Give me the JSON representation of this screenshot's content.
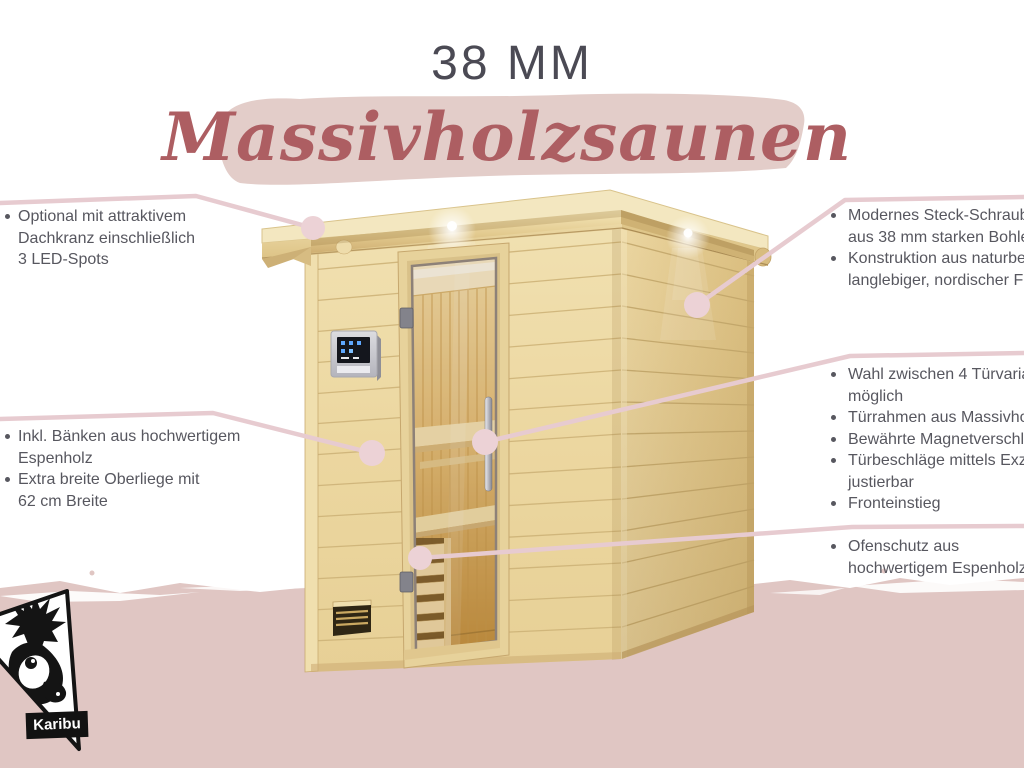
{
  "header": {
    "size_label": "38 MM",
    "product_line": "Massivholzsaunen"
  },
  "brand": {
    "name": "Karibu"
  },
  "bullets": {
    "left_top": [
      {
        "lines": [
          "Optional mit attraktivem",
          "Dachkranz einschließlich",
          "3 LED-Spots"
        ]
      }
    ],
    "left_mid": [
      {
        "lines": [
          "Inkl. Bänken aus hochwertigem",
          "Espenholz"
        ]
      },
      {
        "lines": [
          "Extra breite Oberliege mit",
          "62 cm Breite"
        ]
      }
    ],
    "right_top": [
      {
        "lines": [
          "Modernes Steck-Schraubsystem",
          "aus 38 mm starken Bohlen"
        ]
      },
      {
        "lines": [
          "Konstruktion aus naturbelassener,",
          "langlebiger, nordischer Fichte"
        ]
      }
    ],
    "right_mid": [
      {
        "lines": [
          "Wahl zwischen 4 Türvarianten",
          "möglich"
        ]
      },
      {
        "lines": [
          "Türrahmen aus Massivholz"
        ]
      },
      {
        "lines": [
          "Bewährte Magnetverschlusstechnik"
        ]
      },
      {
        "lines": [
          "Türbeschläge mittels Exzenter",
          "justierbar"
        ]
      },
      {
        "lines": [
          "Fronteinstieg"
        ]
      }
    ],
    "right_bottom": [
      {
        "lines": [
          "Ofenschutz aus",
          "hochwertigem Espenholz"
        ]
      }
    ]
  },
  "icons": {
    "brand_logo": "deer-triangle-logo",
    "callout_marker": "pink-dot-marker"
  },
  "colors": {
    "title_gray": "#4b4a54",
    "script_red": "#ad5e62",
    "brush_pink": "#e3cdc9",
    "footer_pink": "#e0c6c3",
    "callout_line": "#e7cbd0",
    "callout_dot": "#ecd2d6",
    "body_text": "#57575f",
    "wood_light": "#eedcab",
    "wood_side": "#e2c98b"
  }
}
